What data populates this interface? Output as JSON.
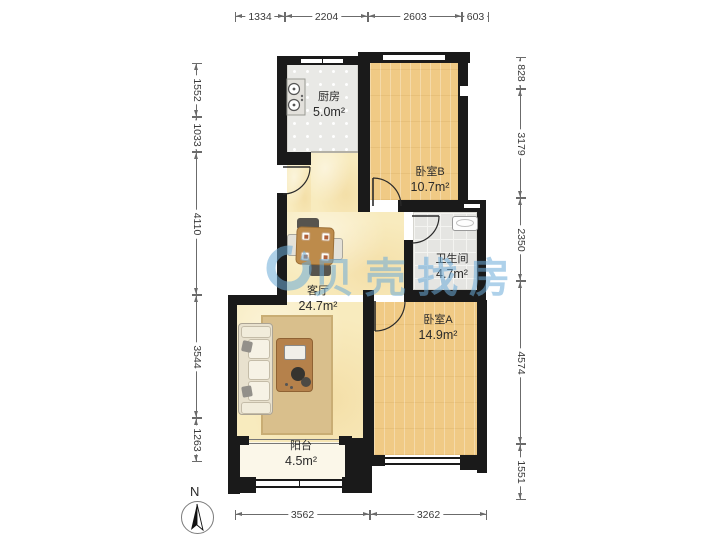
{
  "watermark": {
    "text": "贝壳找房",
    "color": "#6cacd8"
  },
  "compass": {
    "north_label": "N"
  },
  "rooms": {
    "kitchen": {
      "name": "厨房",
      "area": "5.0m²"
    },
    "bedroom_b": {
      "name": "卧室B",
      "area": "10.7m²"
    },
    "bathroom": {
      "name": "卫生间",
      "area": "4.7m²"
    },
    "living_room": {
      "name": "客厅",
      "area": "24.7m²"
    },
    "bedroom_a": {
      "name": "卧室A",
      "area": "14.9m²"
    },
    "balcony": {
      "name": "阳台",
      "area": "4.5m²"
    }
  },
  "dimensions_mm": {
    "top": [
      "1334",
      "2204",
      "2603",
      "603"
    ],
    "bottom": [
      "3562",
      "3262"
    ],
    "left": [
      "1552",
      "1033",
      "4110",
      "3544",
      "1263"
    ],
    "right": [
      "828",
      "3179",
      "2350",
      "4574",
      "1551"
    ]
  }
}
